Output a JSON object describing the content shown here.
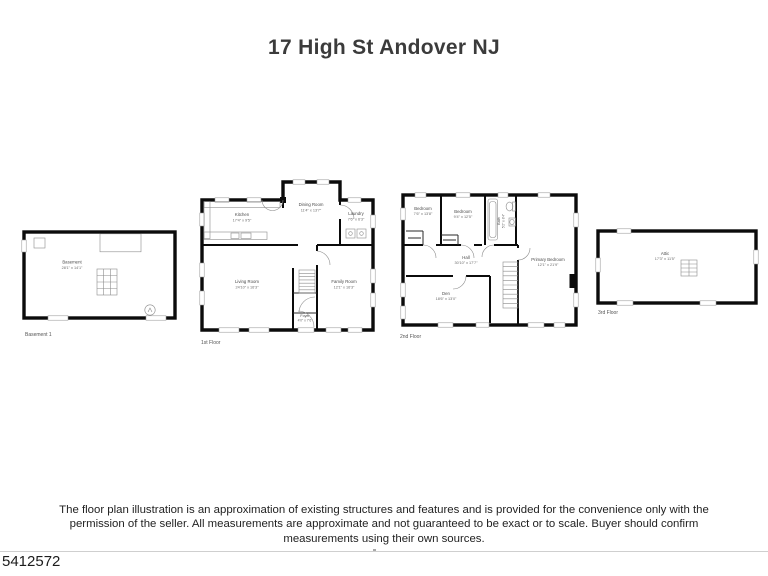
{
  "title": "17 High St Andover NJ",
  "listing_id": "5412572",
  "disclaimer": "The floor plan illustration is an approximation of existing structures and features and is provided for the convenience only with the permission of the seller. All measurements are approximate and not guaranteed to be exact or to scale. Buyer should confirm measurements using their own sources.",
  "colors": {
    "wall": "#0b0b0b",
    "text": "#4a4a4a",
    "fixture": "#8c8c8c"
  },
  "plans": {
    "basement": {
      "name": "Basement 1",
      "rooms": {
        "basement": {
          "label": "Basement",
          "dims": "28'1\" x 14'1\""
        }
      }
    },
    "first": {
      "name": "1st Floor",
      "rooms": {
        "kitchen": {
          "label": "Kitchen",
          "dims": "17'4\" x 9'5\""
        },
        "dining": {
          "label": "Dining Room",
          "dims": "11'4\" x 13'7\""
        },
        "laundry": {
          "label": "Laundry",
          "dims": "7'6\" x 6'3\""
        },
        "living": {
          "label": "Living Room",
          "dims": "24'10\" x 16'3\""
        },
        "family": {
          "label": "Family Room",
          "dims": "12'1\" x 16'3\""
        },
        "foyer": {
          "label": "Foyer",
          "dims": "4'0\" x 7'6\""
        }
      }
    },
    "second": {
      "name": "2nd Floor",
      "rooms": {
        "bedroom1": {
          "label": "Bedroom",
          "dims": "7'6\" x 13'8\""
        },
        "bedroom2": {
          "label": "Bedroom",
          "dims": "9'4\" x 12'5\""
        },
        "bath": {
          "label": "Bath",
          "dims": "5'2\" x 8'4\""
        },
        "hall": {
          "label": "Hall",
          "dims": "30'10\" x 17'7\""
        },
        "primary": {
          "label": "Primary Bedroom",
          "dims": "12'1\" x 21'9\""
        },
        "den": {
          "label": "Den",
          "dims": "18'6\" x 13'0\""
        }
      }
    },
    "attic": {
      "name": "3rd Floor",
      "rooms": {
        "attic": {
          "label": "Attic",
          "dims": "17'3\" x 11'5\""
        }
      }
    }
  }
}
